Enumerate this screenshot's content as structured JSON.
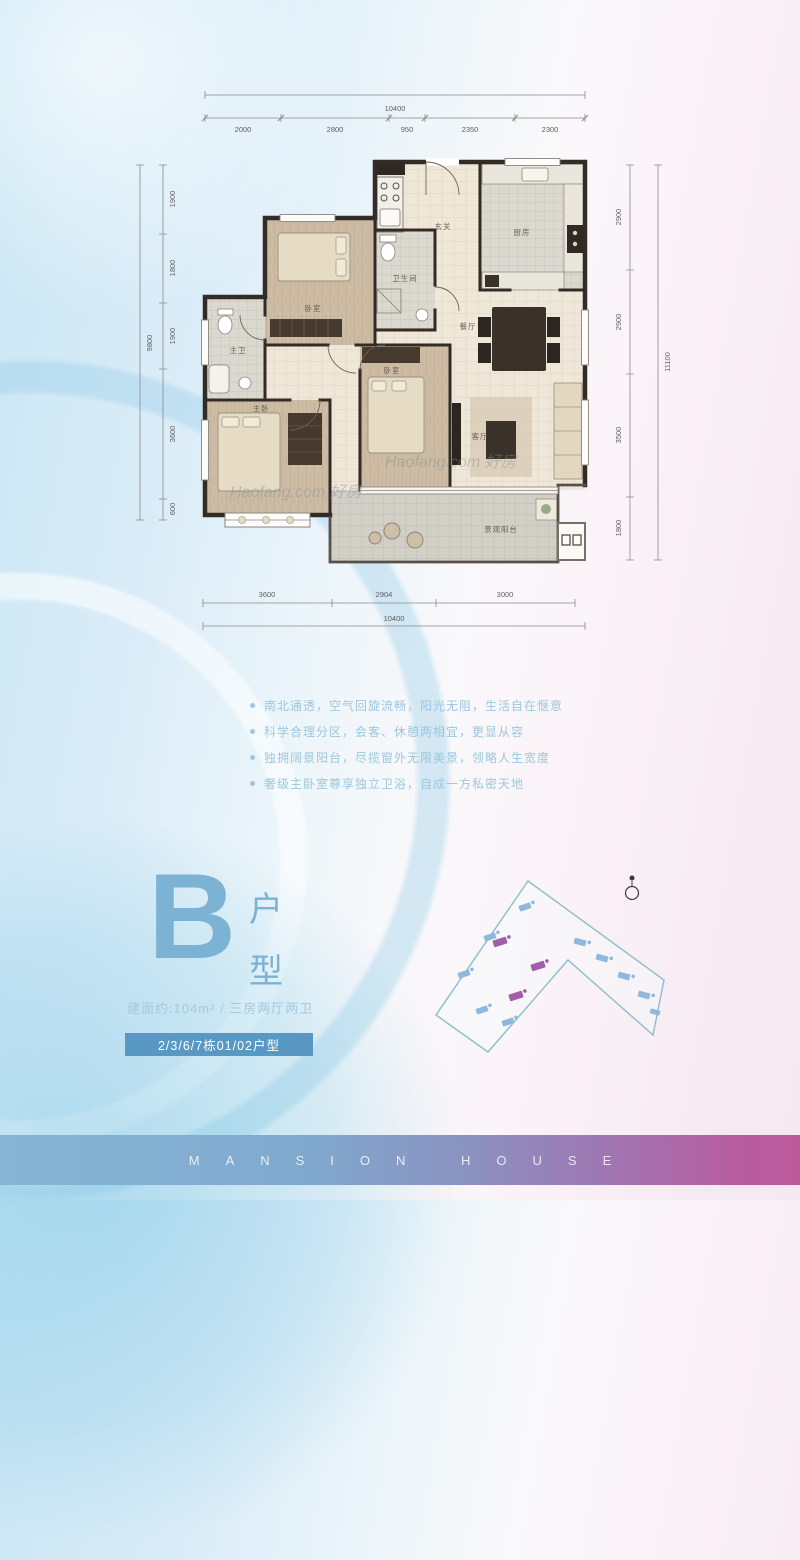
{
  "floor_plan": {
    "dims": {
      "top_total": "10400",
      "top_segments": [
        "2000",
        "2800",
        "950",
        "2350",
        "2300"
      ],
      "left_total": "9800",
      "left_segments": [
        "1900",
        "1800",
        "1900",
        "3600",
        "600"
      ],
      "right_total": "11100",
      "right_segments": [
        "2900",
        "2900",
        "3500",
        "1800"
      ],
      "bottom_total": "10400",
      "bottom_segments": [
        "3600",
        "2904",
        "3000"
      ]
    },
    "rooms": [
      "玄关",
      "厨房",
      "卫生间",
      "卧室",
      "主卫",
      "主卧",
      "卧室",
      "餐厅",
      "客厅",
      "景观阳台"
    ],
    "watermark": "Haofang.com 好房"
  },
  "features": [
    "南北通透，空气回旋流畅，阳光无阻，生活自在惬意",
    "科学合理分区，会客、休憩两相宜，更显从容",
    "独拥阔景阳台，尽揽窗外无限美景，领略人生宽度",
    "奢级主卧室尊享独立卫浴，自成一方私密天地"
  ],
  "unit": {
    "letter": "B",
    "type_char_1": "户",
    "type_char_2": "型",
    "area_line": "建面约:104m²  /  三房两厅两卫",
    "banner": "2/3/6/7栋01/02户型"
  },
  "footer": {
    "brand": "MANSION HOUSE"
  },
  "colors": {
    "accent": "#7cb2d4",
    "banner_bg": "#5898c2",
    "bullet_text": "#9cc7de",
    "footer_left": "#87b6d5",
    "footer_right": "#b75da0",
    "keyplan_outline": "#8abfc9",
    "unit_marker_blue": "#8fb8dc",
    "unit_marker_purple": "#a05fa8"
  }
}
